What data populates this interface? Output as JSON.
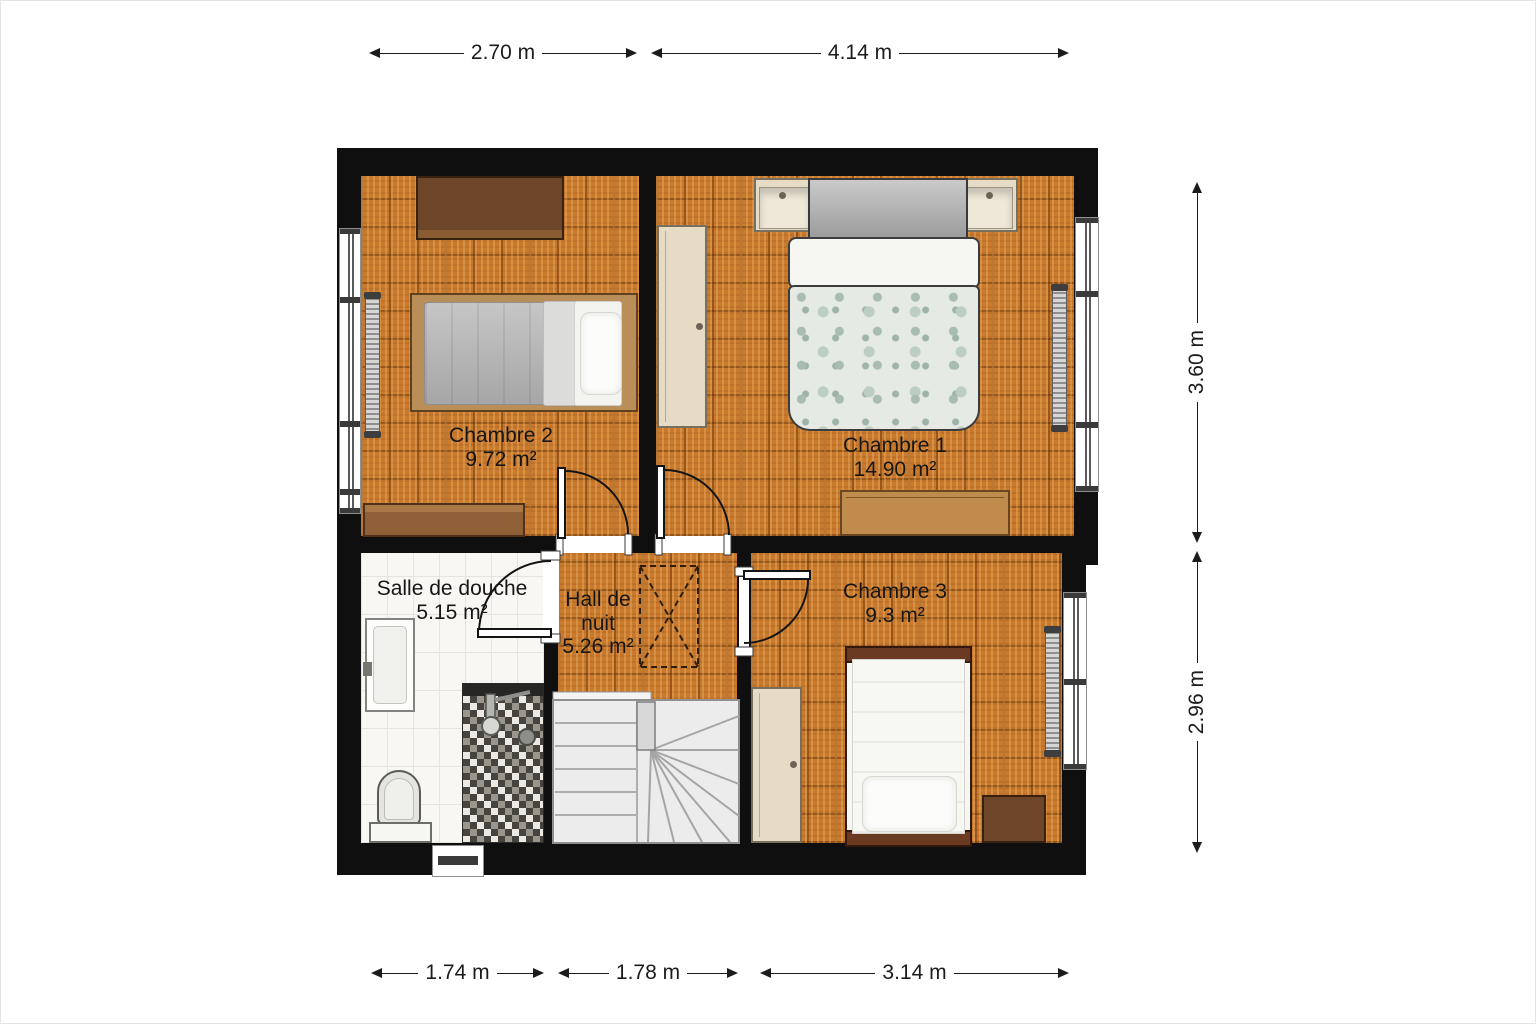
{
  "rooms": [
    {
      "name": "Chambre 2",
      "area": "9.72 m²"
    },
    {
      "name": "Chambre 1",
      "area": "14.90 m²"
    },
    {
      "name": "Salle de douche",
      "area": "5.15 m²"
    },
    {
      "name_lines": [
        "Hall de",
        "nuit"
      ],
      "area": "5.26 m²"
    },
    {
      "name": "Chambre 3",
      "area": "9.3 m²"
    }
  ],
  "dims": {
    "top": [
      {
        "label": "2.70 m"
      },
      {
        "label": "4.14 m"
      }
    ],
    "right": [
      {
        "label": "3.60 m"
      },
      {
        "label": "2.96 m"
      }
    ],
    "bottom": [
      {
        "label": "1.74 m"
      },
      {
        "label": "1.78 m"
      },
      {
        "label": "3.14 m"
      }
    ]
  },
  "colors": {
    "wall": "#0f0f0f",
    "parquet": "#c97a2c",
    "bathroom_tile": "#f8f7f4",
    "stairs": "#ececec",
    "wood_dark": "#6d4629",
    "wood_medium": "#8f6038",
    "wood_light": "#c08c4e",
    "cream_furniture": "#e6dcc5",
    "duvet": "#e6eae4"
  }
}
